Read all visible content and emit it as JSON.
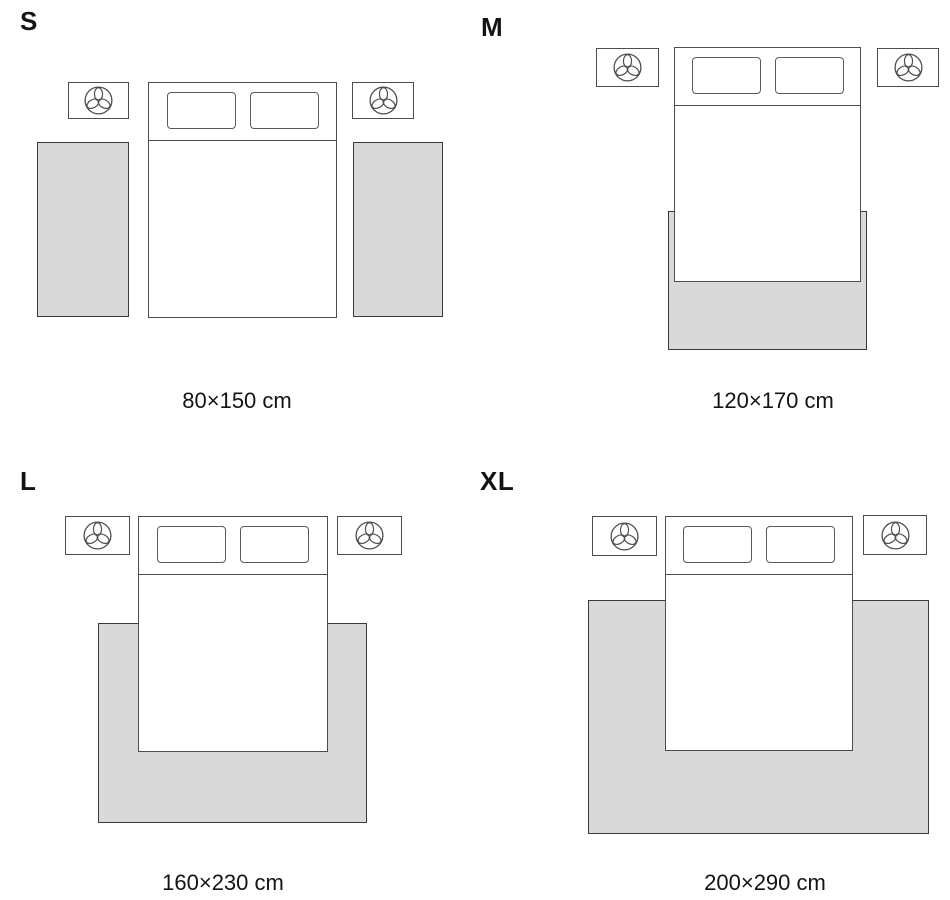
{
  "guide": {
    "sizes": [
      {
        "label": "S",
        "dimensions": "80×150 cm",
        "layout": "two runner rugs beside bed"
      },
      {
        "label": "M",
        "dimensions": "120×170 cm",
        "layout": "rug under lower part of bed"
      },
      {
        "label": "L",
        "dimensions": "160×230 cm",
        "layout": "rug under bed extending to sides and foot"
      },
      {
        "label": "XL",
        "dimensions": "200×290 cm",
        "layout": "large rug spanning under bed and nightstand width"
      }
    ]
  },
  "icons": {
    "nightstand_decor": "plant-icon"
  },
  "colors": {
    "rug_fill": "#d9d9d9",
    "rug_border": "#3a3a3a",
    "furniture_line": "#4d4d4d",
    "text_color": "#141414",
    "bg": "#ffffff"
  }
}
